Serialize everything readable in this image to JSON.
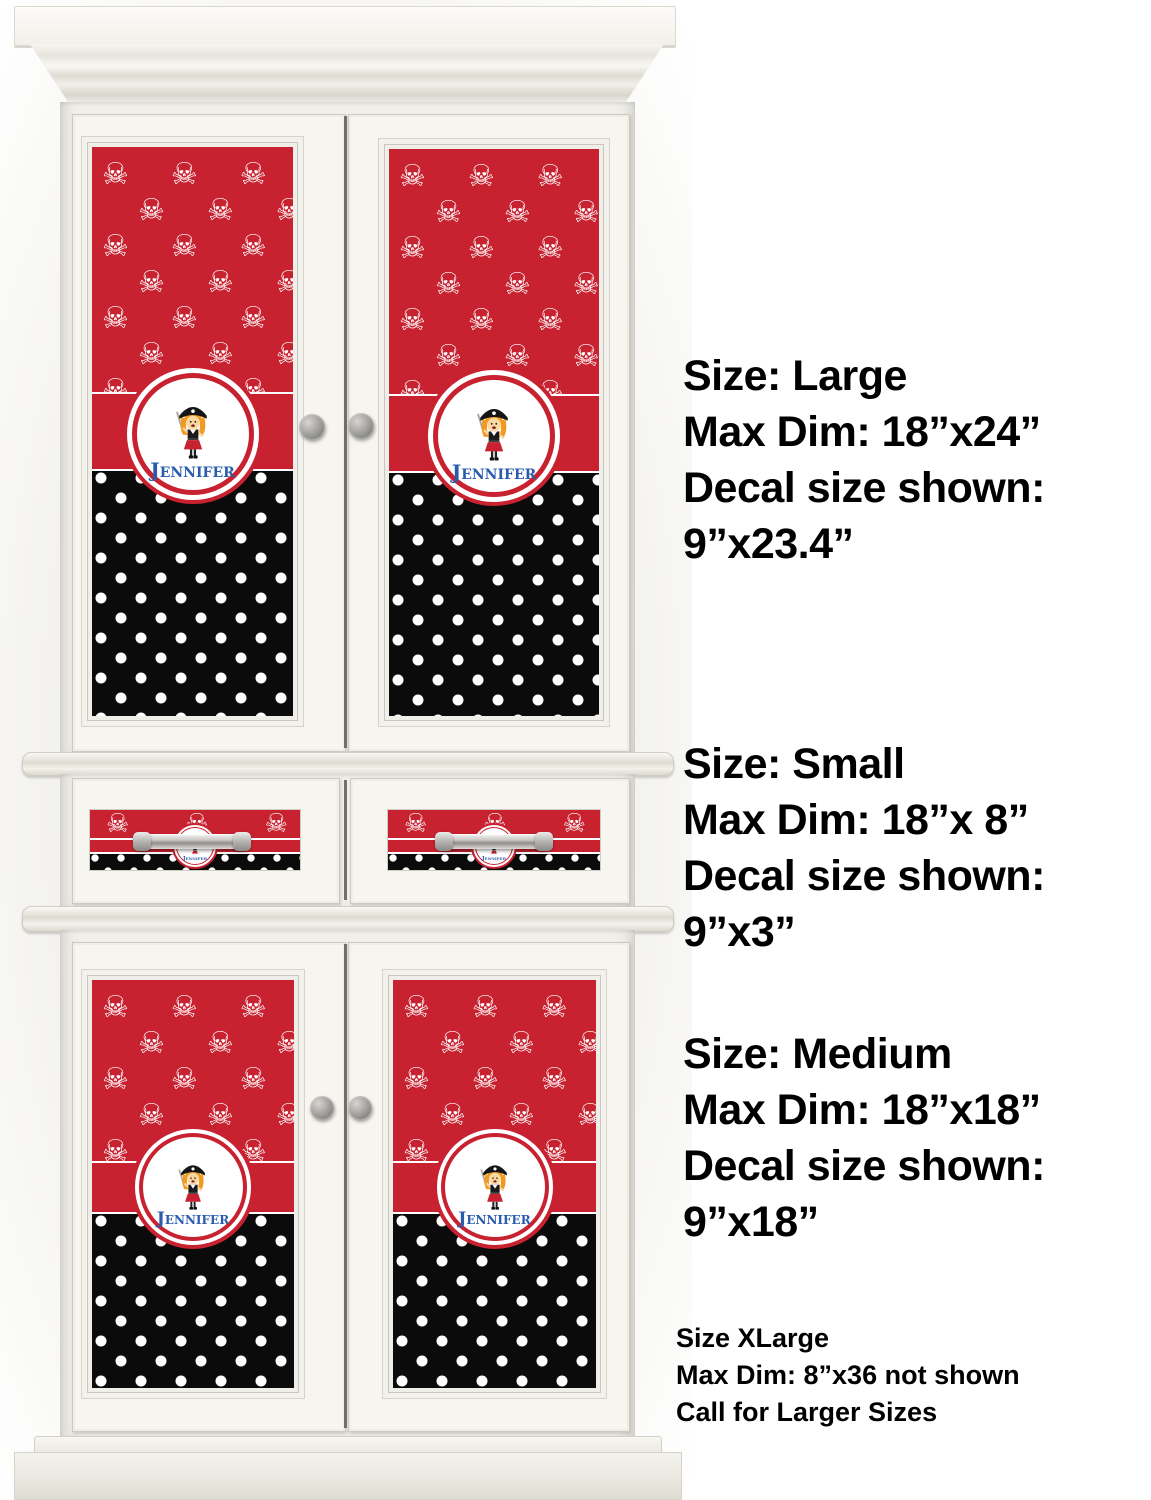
{
  "product": {
    "description": "Girl's Pirate / Polka Dots personalized decal shown on white armoire",
    "decal": {
      "name": "Jennifer",
      "colors": {
        "red": "#C82130",
        "black": "#0B0B0B",
        "name_blue": "#2A5CAE",
        "white": "#FFFFFF"
      }
    }
  },
  "size_info": {
    "large": {
      "lines": [
        "Size: Large",
        "Max Dim: 18”x24”",
        "Decal size shown:",
        "9”x23.4”"
      ]
    },
    "small": {
      "lines": [
        "Size: Small",
        "Max Dim: 18”x 8”",
        "Decal size shown:",
        "9”x3”"
      ]
    },
    "medium": {
      "lines": [
        "Size: Medium",
        "Max Dim: 18”x18”",
        "Decal size shown:",
        "9”x18”"
      ]
    },
    "xlarge": {
      "lines": [
        "Size XLarge",
        "Max Dim: 8”x36 not shown",
        "Call for Larger Sizes"
      ]
    }
  }
}
